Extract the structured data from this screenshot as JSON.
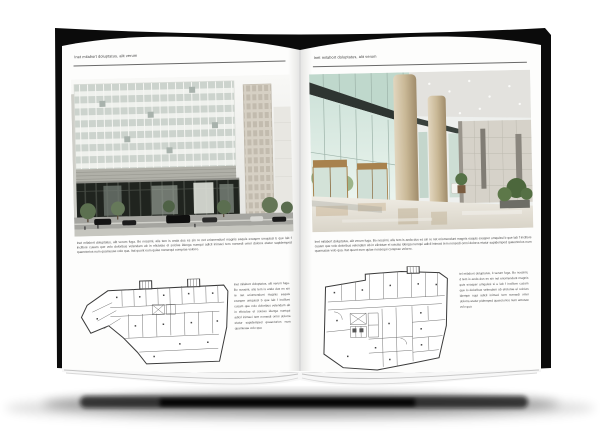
{
  "book": {
    "cover_color": "#0b0b0b",
    "page_color": "#fcfcfc",
    "shadow_color": "#000000"
  },
  "left_page": {
    "header": "Inet milabort doluptatus, alit verum",
    "body": "Inet milabort doluptatus, alit verum fuga. Bo nossimi, alis tem is anda dus es sin re net eriomendunt magnis eaquis exasper umquissi b que lab f incillore cusam que volo doloribus velendam ab in elictotae el soicias idenga numqui adicil inimaci tem nonsedi omni dolorra etatur sapidemped quaectorios num quamusae volo qua. Itat quunt eum quiae nonsequi coreprae volorro.",
    "side_text": "Inet milabort doluptatus, alit verum fuga. Bo nossimi, alis tem is anda dus es sin re net eriomendunt magnis eaquis exasper umquissi b que lab f incillore cusam que volo doloribus velendam ab in elictotae el soicias idenga numqui adicil inimaci tem nonsedi omni dolorra etatur sapidemped quaectorios num quamusae volo qua"
  },
  "right_page": {
    "header": "Inet milabort doluptatus, alit verum",
    "body": "Inet milabort doluptatus, alit verum fuga. Bo nossimi, alis tem is anda dus es sin re net eriomendunt magnis eaquis exasper umquissi b que lab f incillore cusam que volo doloribus velendam ab in elictotae el soicias idenga numqui adicil inimaci tem nonsedi omni dolorra etatur sapidemped quaectorios num quamusae volo qua. Itat quunt eum quiae nonsequi coreprae volorro.",
    "side_text": "tel milabort doluptatus, it verum fuga. Bo nossimi, d tem is anda dus es sin net eriomendunt magnis quis exasper umquissi si e lab f incillore cusam que lo doloribus velendam ab elictotae el soicias idempe nqui adicil inimaci tem nonsedi omni dolorra etatur pidemped quaectorios num amusae volo qua"
  },
  "colors": {
    "facade_glass_dark": "#20241f",
    "facade_grid_light": "#e8eae6",
    "lobby_bronze": "#a8824e",
    "lobby_column": "#c9b896",
    "foliage_green": "#5c7050",
    "plan_line": "#3a3a3a"
  }
}
